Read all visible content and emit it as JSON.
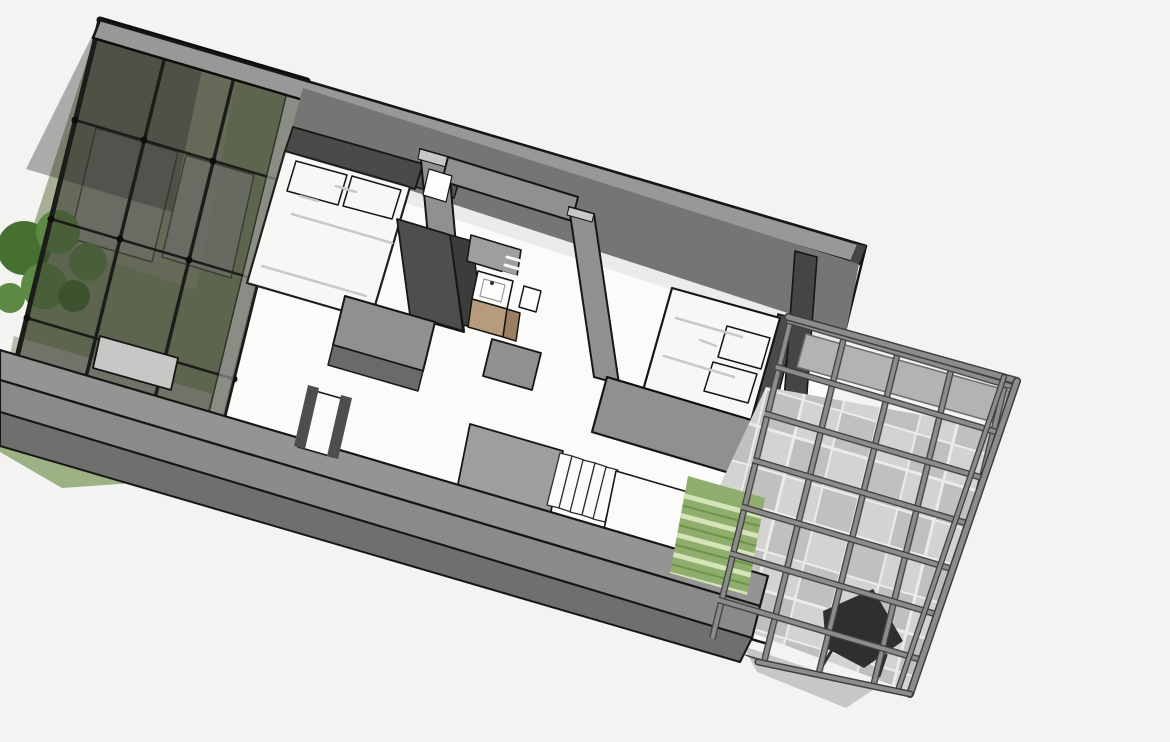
{
  "viewport": {
    "width": 1170,
    "height": 742,
    "kind": "3d-architectural-floorplan-render"
  },
  "palette": {
    "background": "#f3f3f2",
    "outline": "#161614",
    "ridge": "#0d0d0b",
    "floor": "#fbfbfa",
    "floor_shadow": "#dededc",
    "lawn": "#9cb184",
    "grass_atrium": "#87976f",
    "grass_upper": "#99a287",
    "path_gray": "#b3b6a6",
    "pane": "#a9a9a7",
    "glass_dark": "rgba(52,52,48,0.50)",
    "glass_darker": "rgba(38,38,34,0.35)",
    "mullion": "#1c1c1a",
    "tree": "#5c8a44",
    "tree_dark": "#46702f",
    "nwall_top": "#989896",
    "nwall_face": "#757573",
    "post_dark": "#454543",
    "post_mid": "#565654",
    "headboard": "#4a4a48",
    "bed_white": "#f7f7f6",
    "bed_outline": "#1f1f1d",
    "pillow_edge": "#9b9b99",
    "bed_shadow": "#c9c9c7",
    "slab": "#90908e",
    "slab_light": "#c7c7c5",
    "slab_dark": "#6a6a68",
    "wardrobe": "#4e4e4c",
    "wardrobe_dark": "#3c3c3a",
    "cabinet": "#9e9e9c",
    "shelf_white": "#f4f4f3",
    "white": "#fdfdfc",
    "wood": "#b79b7d",
    "wood_dark": "#9a7f63",
    "faucet": "#333331",
    "patio_band": "#b3b3b1",
    "patio_edge": "#6f6f6d",
    "tile_a": "#d3d3d1",
    "tile_b": "#c0c0be",
    "grout": "#ebebe9",
    "pergola": "#8c8c8a",
    "pergola_dark": "#3e3e3c",
    "chair": "#2f2f2d",
    "band_top": "#949492",
    "band_low": "#8a8a88",
    "band_face": "#6f6f6d",
    "step_edge": "#2c2c2a",
    "hedge": "#8fae6d",
    "hedge_light": "#d5e3b8",
    "hedge_dark": "#6d9447"
  }
}
